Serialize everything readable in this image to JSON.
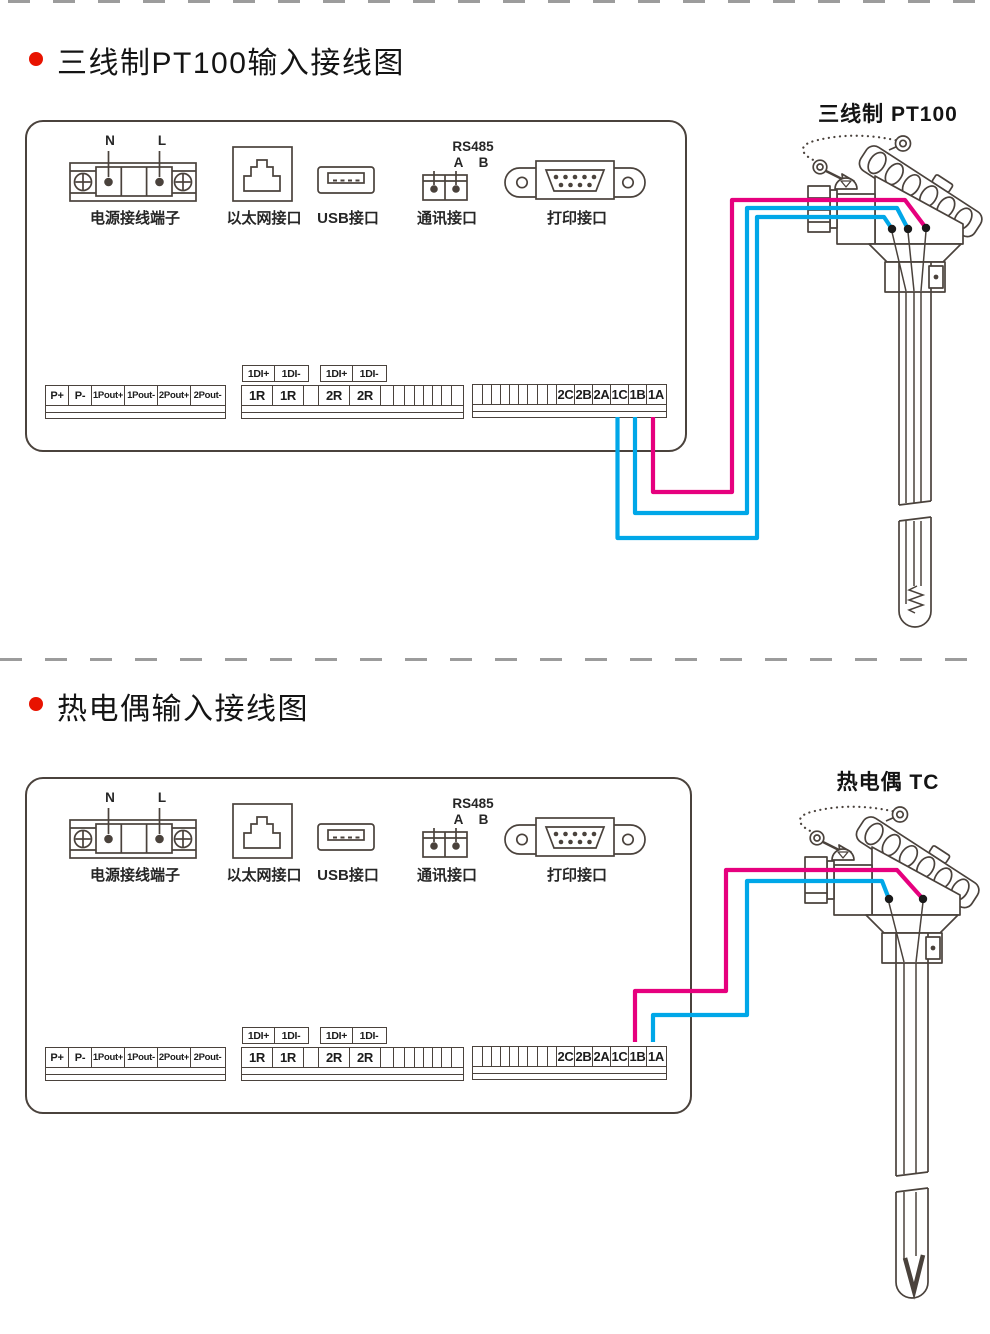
{
  "titles": {
    "section1": "三线制PT100输入接线图",
    "section2": "热电偶输入接线图"
  },
  "sensors": {
    "pt100_label": "三线制 PT100",
    "tc_label": "热电偶 TC"
  },
  "rear_panel": {
    "power": {
      "label": "电源接线端子",
      "n": "N",
      "l": "L"
    },
    "ethernet_label": "以太网接口",
    "usb_label": "USB接口",
    "comm": {
      "label": "通讯接口",
      "bus": "RS485",
      "a": "A",
      "b": "B"
    },
    "print_label": "打印接口",
    "strip_left": {
      "cells": [
        "P+",
        "P-",
        "1Pout+",
        "1Pout-",
        "2Pout+",
        "2Pout-"
      ]
    },
    "strip_mid": {
      "headers": [
        "1DI+",
        "1DI-",
        "1DI+",
        "1DI-"
      ],
      "cells": [
        "1R",
        "1R",
        "2R",
        "2R"
      ]
    },
    "strip_right": {
      "cells": [
        "2C",
        "2B",
        "2A",
        "1C",
        "1B",
        "1A"
      ]
    }
  },
  "wiring": {
    "pt100_connections": [
      {
        "terminal": "1C",
        "color": "#00a7e8"
      },
      {
        "terminal": "1B",
        "color": "#00a7e8"
      },
      {
        "terminal": "1A",
        "color": "#e6007e"
      }
    ],
    "tc_connections": [
      {
        "terminal": "1B",
        "color": "#e6007e"
      },
      {
        "terminal": "1A",
        "color": "#00a7e8"
      }
    ]
  },
  "colors": {
    "magenta": "#e6007e",
    "cyan": "#00a7e8",
    "line": "#4a423c",
    "bullet": "#e81300",
    "dash": "#9c9c9c"
  }
}
